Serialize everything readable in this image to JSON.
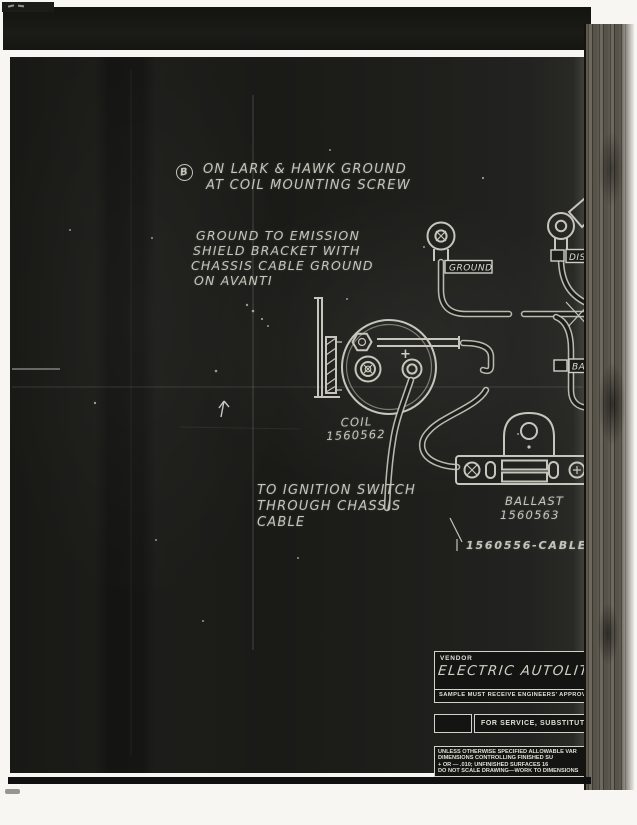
{
  "scan": {
    "annotations": {
      "note_b_marker": "B",
      "note_b_line1": "ON LARK & HAWK GROUND",
      "note_b_line2": "AT COIL MOUNTING SCREW",
      "ground_note_line1": "GROUND TO EMISSION",
      "ground_note_line2": "SHIELD BRACKET WITH",
      "ground_note_line3": "CHASSIS CABLE GROUND",
      "ground_note_line4": "ON AVANTI",
      "ignition_note_line1": "TO IGNITION SWITCH",
      "ignition_note_line2": "THROUGH CHASSIS",
      "ignition_note_line3": "CABLE"
    },
    "diagram_labels": {
      "ground_tag": "GROUND",
      "dist_tag": "DIST",
      "bal_tag": "BAL",
      "coil_name": "COIL",
      "coil_part_no": "1560562",
      "coil_plus": "+",
      "ballast_name": "BALLAST",
      "ballast_part_no": "1560563",
      "cable_callout": "1560556-CABLE"
    },
    "title_block": {
      "vendor_label": "VENDOR",
      "vendor_value": "ELECTRIC AUTOLITE",
      "sample_note": "SAMPLE MUST RECEIVE ENGINEERS' APPROV",
      "service_note": "FOR SERVICE, SUBSTITUTE",
      "fine_print_line1": "UNLESS OTHERWISE SPECIFIED ALLOWABLE VAR",
      "fine_print_line2": "DIMENSIONS CONTROLLING FINISHED SU",
      "fine_print_line3": "+ OR — .010; UNFINISHED SURFACES 16",
      "fine_print_line4": "DO NOT SCALE DRAWING—WORK TO DIMENSIONS"
    },
    "colors": {
      "paper_white": "#f7f6f2",
      "blueprint_black": "#1c1c19",
      "ink_light": "#c6c6bc",
      "binding_brown": "#4f4b42"
    }
  }
}
